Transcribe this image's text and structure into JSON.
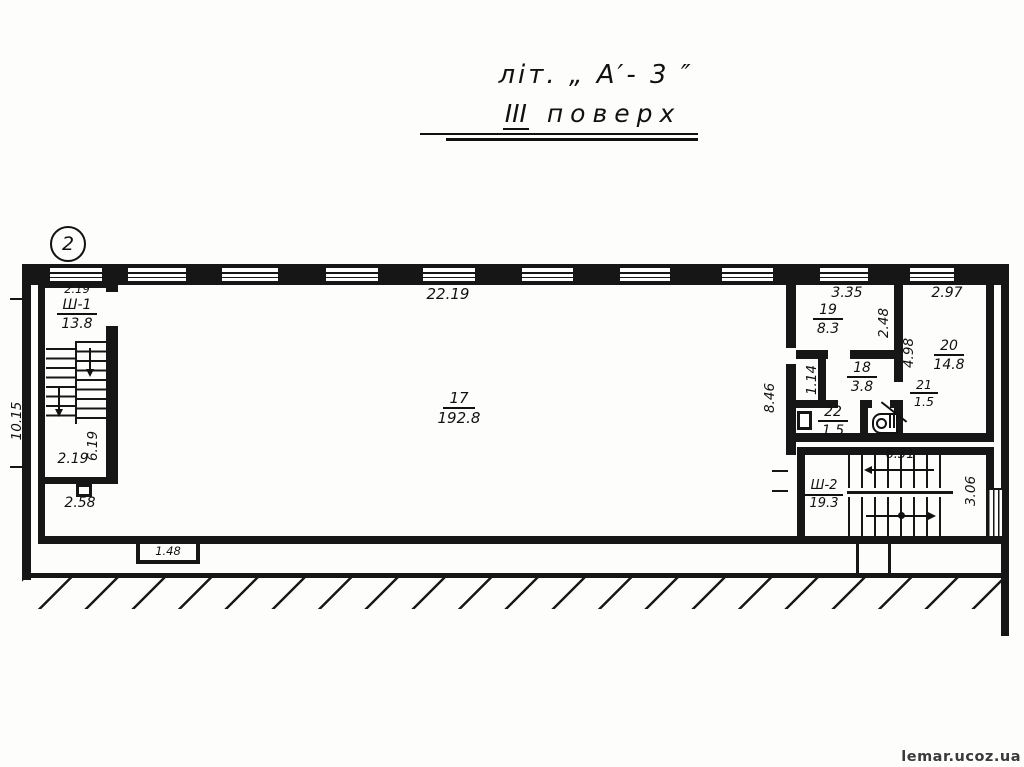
{
  "page": {
    "watermark": "lemar.ucoz.ua"
  },
  "title": {
    "line1": "літ. „ А′- 3 ″",
    "floor_numeral": "ІІІ",
    "floor_word": "поверх"
  },
  "marker": "2",
  "overall": {
    "width_top": "22.19",
    "height_left": "10.15"
  },
  "main_room": {
    "number": "17",
    "area": "192.8"
  },
  "stair1": {
    "dim_top": "2.19",
    "name": "Ш-1",
    "area": "13.8",
    "dim_height": "6.19",
    "dim_bottom": "2.19"
  },
  "porch": {
    "dim": "2.58"
  },
  "bay": {
    "dim": "1.48"
  },
  "room19": {
    "dim_width": "3.35",
    "number": "19",
    "area": "8.3",
    "dim_height": "2.48"
  },
  "room20": {
    "dim_width": "2.97",
    "number": "20",
    "area": "14.8",
    "dim_height": "4.98"
  },
  "room18": {
    "number": "18",
    "area": "3.8",
    "dim_height": "1.14"
  },
  "room21": {
    "number": "21",
    "area": "1.5"
  },
  "room22": {
    "number": "22",
    "area": "1.5"
  },
  "corridor": {
    "dim_height": "8.46"
  },
  "stair2": {
    "name": "Ш-2",
    "area": "19.3",
    "dim_width": "6.31",
    "dim_height": "3.06"
  }
}
